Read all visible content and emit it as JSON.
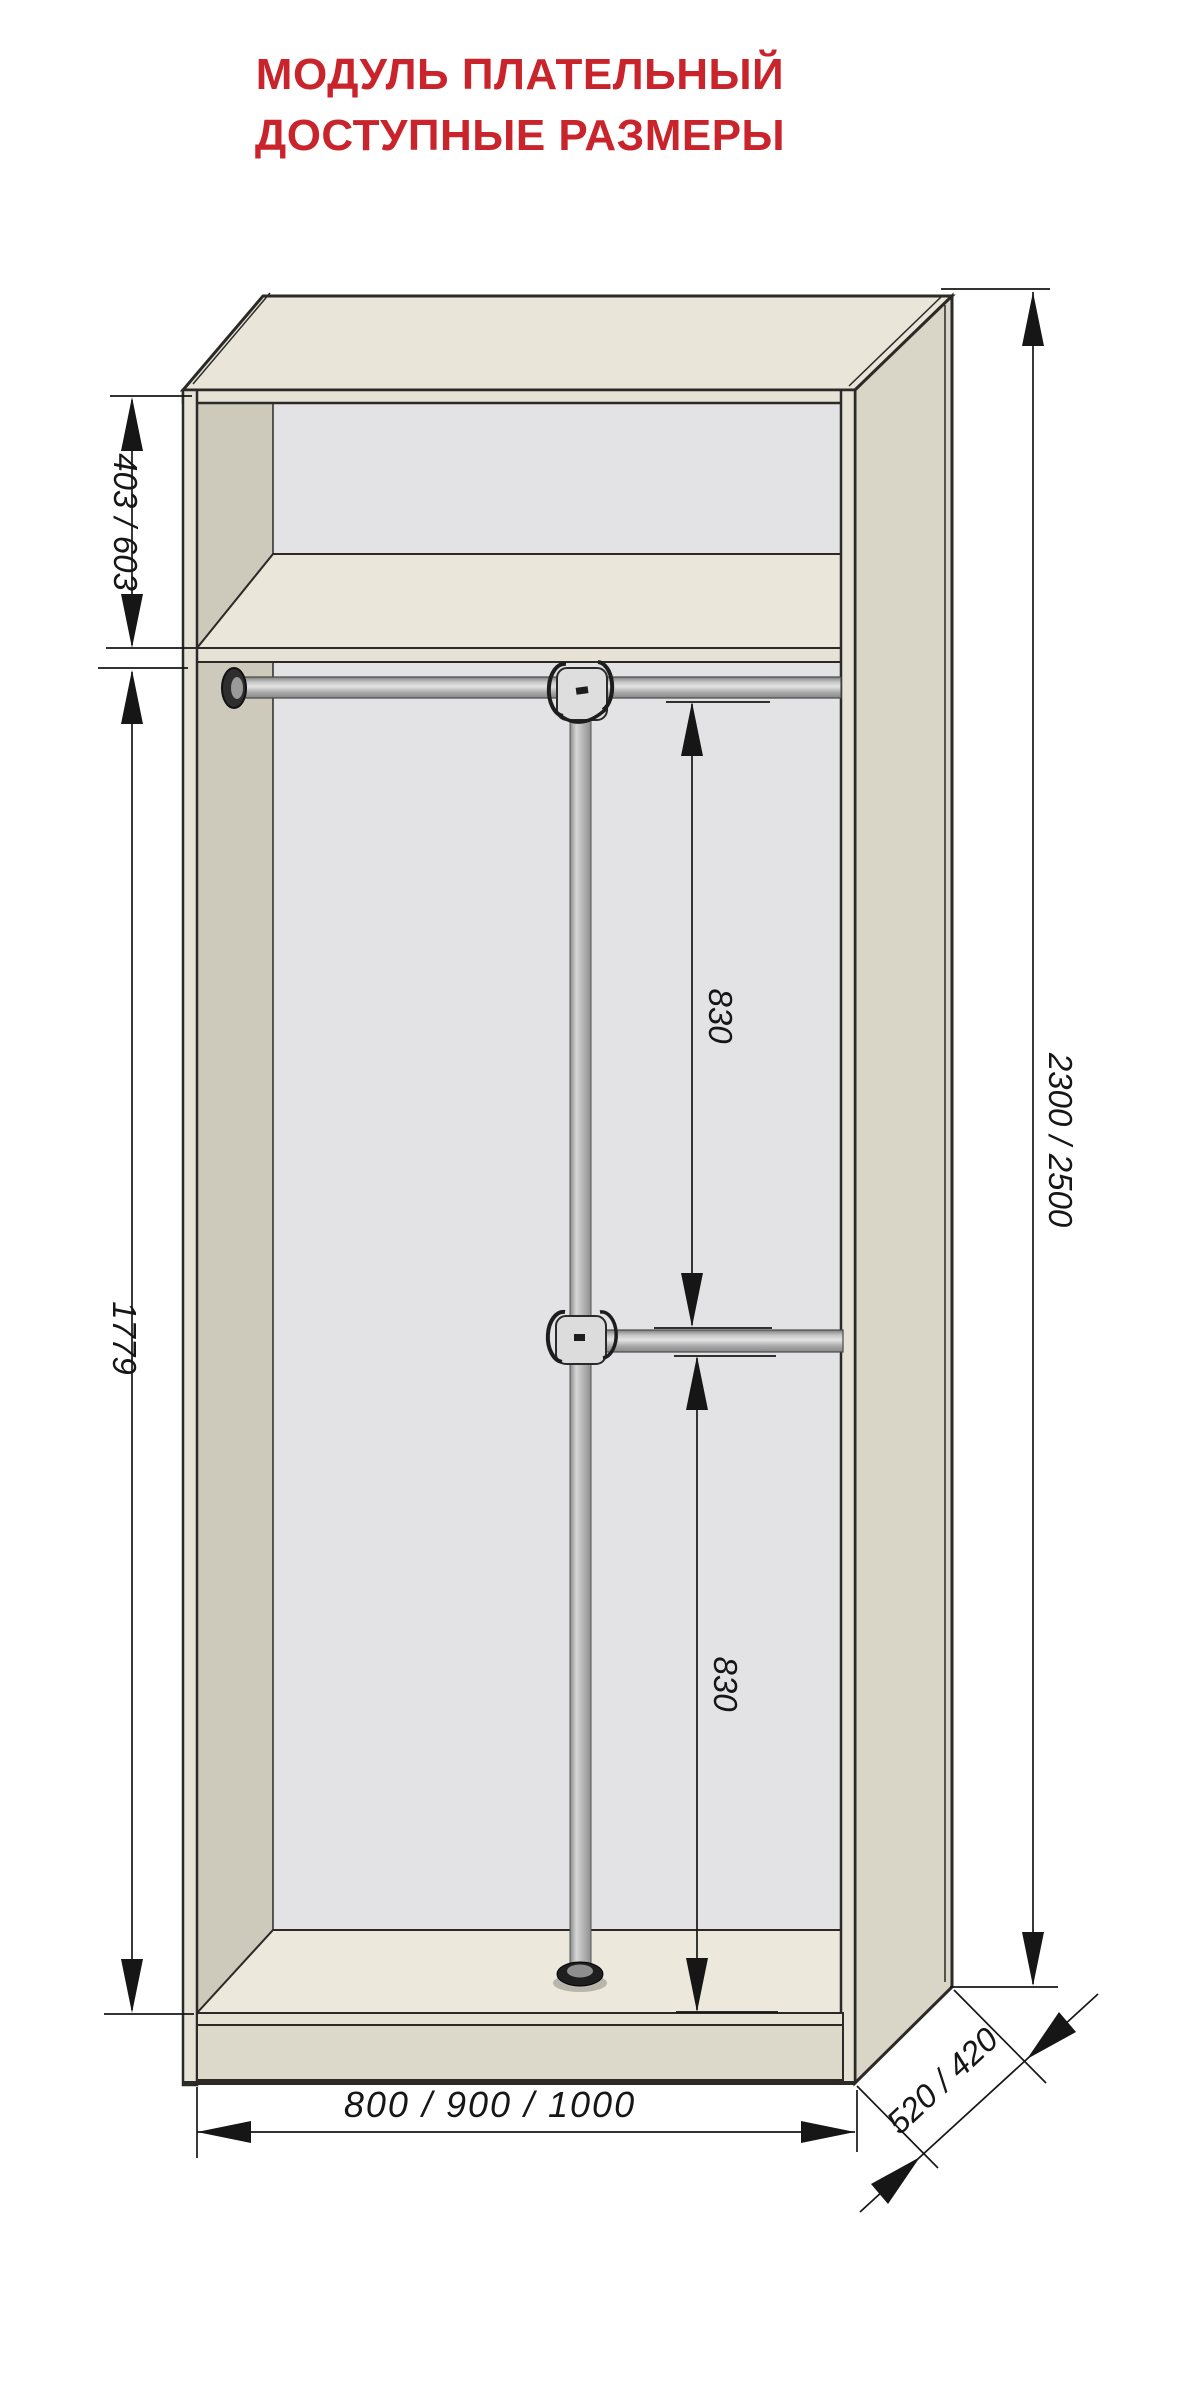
{
  "title": {
    "line1": "МОДУЛЬ ПЛАТЕЛЬНЫЙ",
    "line2": "ДОСТУПНЫЕ РАЗМЕРЫ"
  },
  "colors": {
    "title_red": "#c9242b",
    "outline": "#2b2a27",
    "dimension_ink": "#161616",
    "top_face": "#e9e5d9",
    "side_face": "#d9d5c7",
    "edge_band": "#e6e2d5",
    "interior_back": "#e3e3e5",
    "left_wall": "#cdc9bb",
    "shelf_top": "#eae6da",
    "bottom_face": "#ece8db",
    "plinth": "#dcd8ca"
  },
  "drawing": {
    "object": "wardrobe-clothes-module",
    "view": "3d-front-view-open-interior",
    "dimensions": {
      "top_section_height": "403 / 603",
      "hanging_section_height": "1779",
      "upper_rod_to_middle_rod": "830",
      "middle_rod_to_bottom": "830",
      "overall_height": "2300 / 2500",
      "overall_width": "800 / 900 / 1000",
      "overall_depth": "520 / 420"
    }
  }
}
